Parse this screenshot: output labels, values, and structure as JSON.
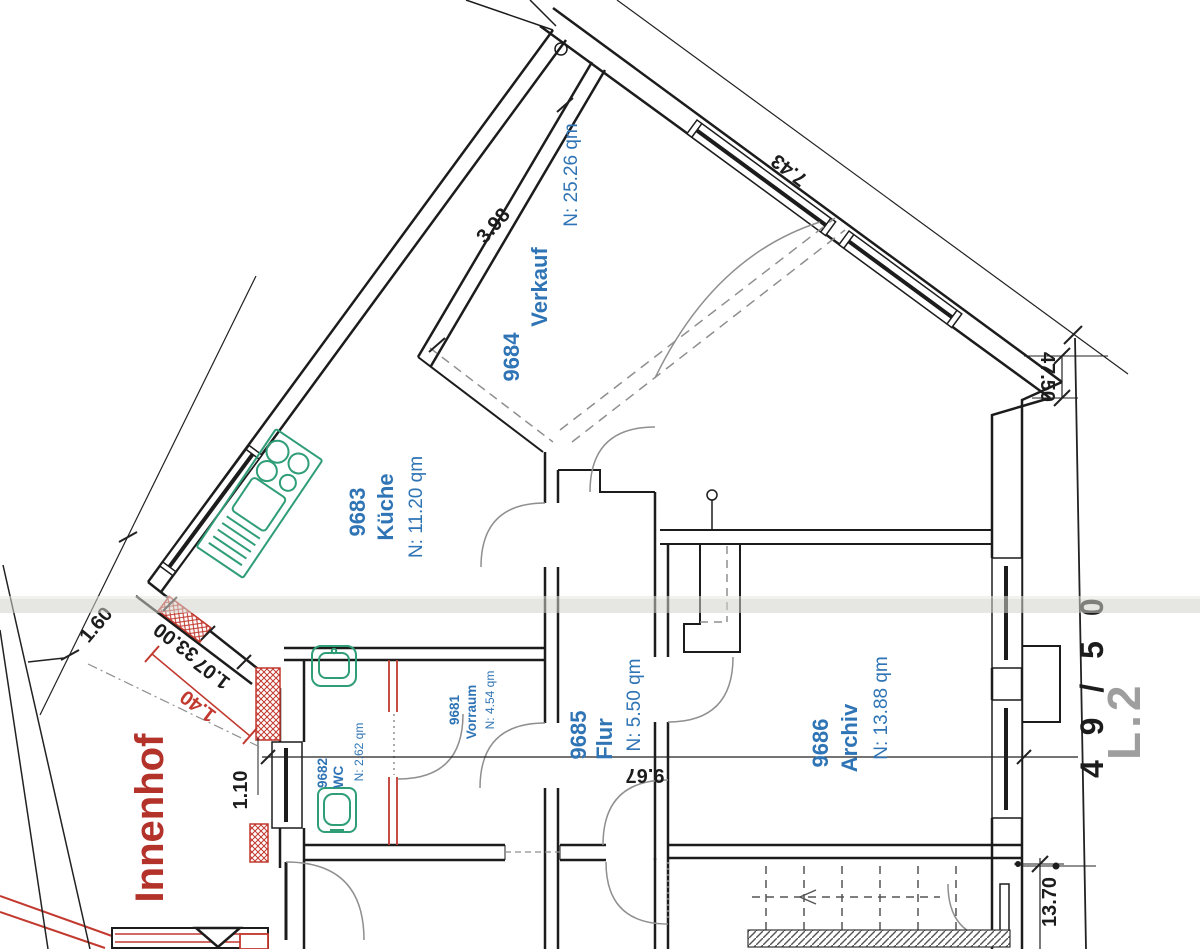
{
  "rooms": [
    {
      "id": "9684",
      "name": "Verkauf",
      "area": "N: 25.26 qm"
    },
    {
      "id": "9683",
      "name": "Küche",
      "area": "N: 11.20 qm"
    },
    {
      "id": "9681",
      "name": "Vorraum",
      "area": "N: 4.54 qm"
    },
    {
      "id": "9682",
      "name": "WC",
      "area": "N: 2.62 qm"
    },
    {
      "id": "9685",
      "name": "Flur",
      "area": "N: 5.50 qm"
    },
    {
      "id": "9686",
      "name": "Archiv",
      "area": "N: 13.88 qm"
    }
  ],
  "courtyard_label": "Innenhof",
  "dimensions": {
    "top_right_wall": "7.43",
    "verkauf_left_wall": "3.98",
    "left_wall": "1.60",
    "right_upper": "47.50",
    "courtyard_a": "33.00",
    "courtyard_b": "1.07",
    "courtyard_red": "1.40",
    "left_lower": "1.10",
    "plan_width": "9.67",
    "bottom_right": "13.70"
  },
  "parcel": {
    "number": "4 9 / 5 0",
    "label": "L.2"
  },
  "colors": {
    "label_blue": "#2f74b5",
    "accent_red": "#c2392f",
    "fixture_green": "#2f9e77",
    "door_gray": "#8f8f8f",
    "wall_black": "#1c1c1c",
    "parcel_gray": "#9e9e9e"
  }
}
